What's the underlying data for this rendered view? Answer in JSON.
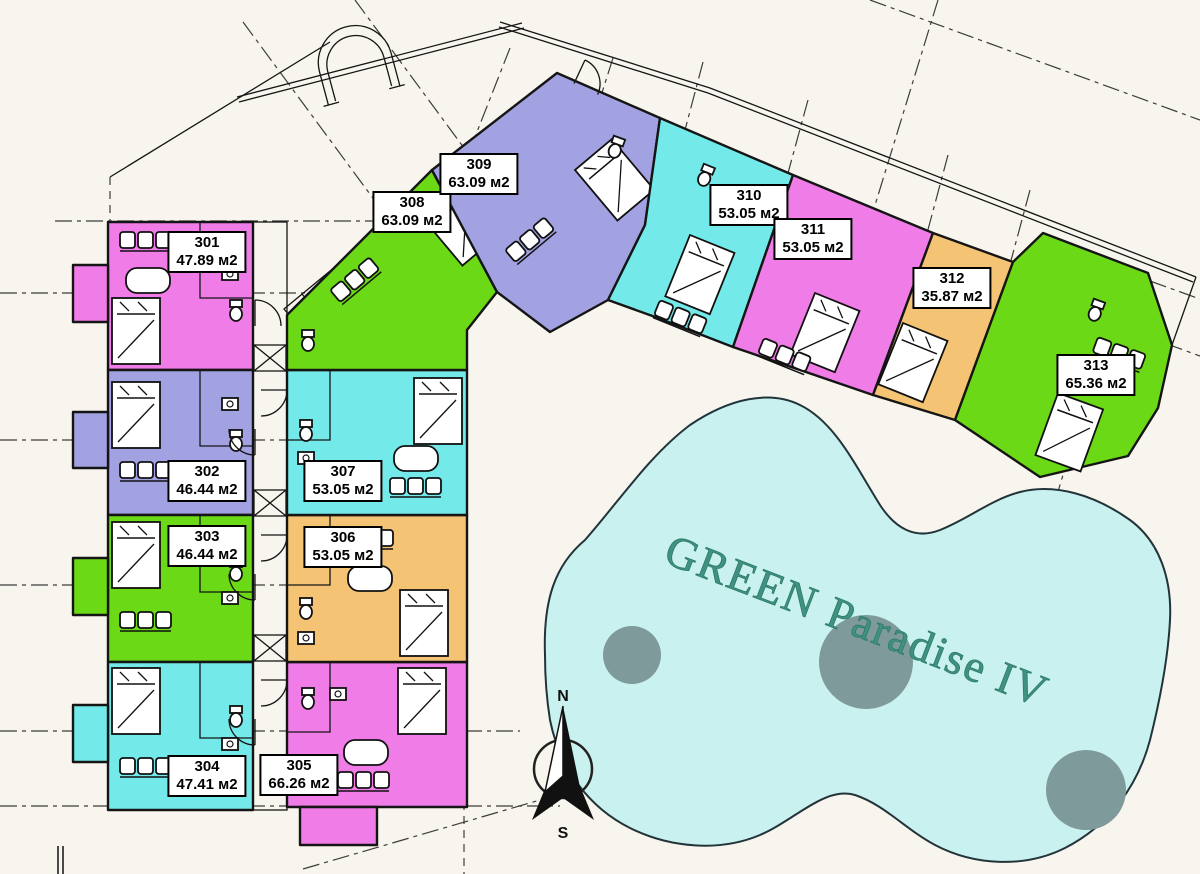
{
  "colors": {
    "background": "#f8f5ee",
    "pink": "#f07ce8",
    "periwinkle": "#a2a2e2",
    "green": "#6bd916",
    "cyan": "#74e9e9",
    "orange": "#f4c474",
    "pool_fill": "#c9f1ef",
    "pool_circle": "#7e9a9a",
    "pool_text": "#3f9181"
  },
  "pool": {
    "label": "GREEN Paradise IV"
  },
  "compass": {
    "north": "N",
    "south": "S"
  },
  "units": [
    {
      "number": "301",
      "area": "47.89 м2",
      "color": "#f07ce8"
    },
    {
      "number": "302",
      "area": "46.44 м2",
      "color": "#a2a2e2"
    },
    {
      "number": "303",
      "area": "46.44 м2",
      "color": "#6bd916"
    },
    {
      "number": "304",
      "area": "47.41 м2",
      "color": "#74e9e9"
    },
    {
      "number": "305",
      "area": "66.26 м2",
      "color": "#f07ce8"
    },
    {
      "number": "306",
      "area": "53.05 м2",
      "color": "#f4c474"
    },
    {
      "number": "307",
      "area": "53.05 м2",
      "color": "#74e9e9"
    },
    {
      "number": "308",
      "area": "63.09 м2",
      "color": "#6bd916"
    },
    {
      "number": "309",
      "area": "63.09 м2",
      "color": "#a2a2e2"
    },
    {
      "number": "310",
      "area": "53.05 м2",
      "color": "#74e9e9"
    },
    {
      "number": "311",
      "area": "53.05 м2",
      "color": "#f07ce8"
    },
    {
      "number": "312",
      "area": "35.87 м2",
      "color": "#f4c474"
    },
    {
      "number": "313",
      "area": "65.36 м2",
      "color": "#6bd916"
    }
  ]
}
